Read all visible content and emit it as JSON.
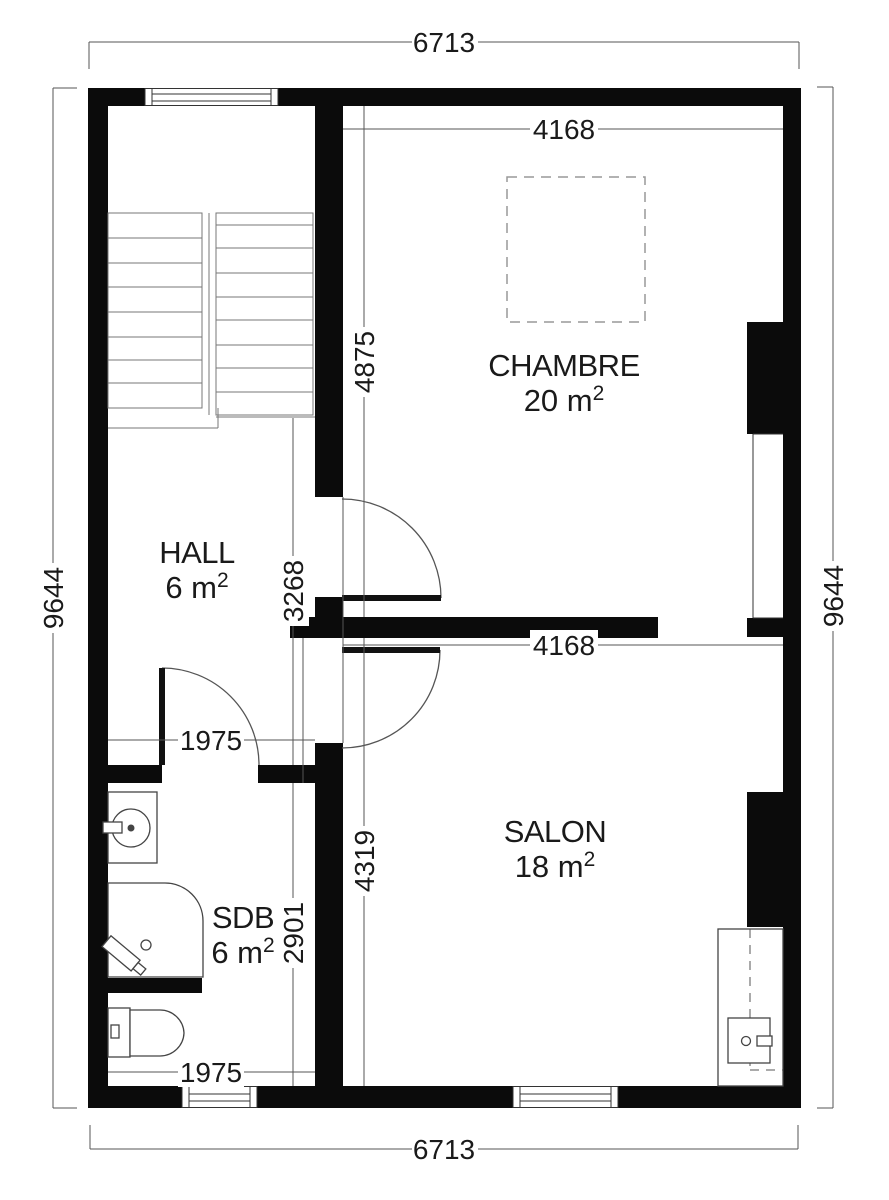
{
  "plan_title": "floor-plan",
  "rooms": [
    {
      "name": "CHAMBRE",
      "area": "20 m",
      "sup": "2"
    },
    {
      "name": "HALL",
      "area": "6 m",
      "sup": "2"
    },
    {
      "name": "SDB",
      "area": "6 m",
      "sup": "2"
    },
    {
      "name": "SALON",
      "area": "18 m",
      "sup": "2"
    }
  ],
  "dimensions": {
    "top_width": "6713",
    "bottom_width": "6713",
    "left_height": "9644",
    "right_height": "9644",
    "chambre_width": "4168",
    "salon_width": "4168",
    "chambre_depth": "4875",
    "salon_depth": "4319",
    "hall_depth": "3268",
    "sdb_depth": "2901",
    "hall_opening": "1975",
    "sdb_opening": "1975"
  },
  "colors": {
    "wall": "#0b0b0b",
    "dimension_line": "#555555",
    "text": "#1a1a1a"
  }
}
